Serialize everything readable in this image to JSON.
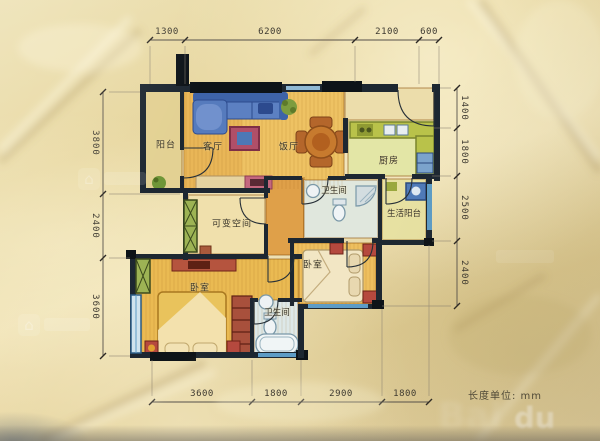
{
  "meta": {
    "unit_label": "长度单位: mm",
    "watermark": {
      "left": "Bai",
      "right": "du"
    }
  },
  "rooms": {
    "balcony": "阳台",
    "living": "客厅",
    "dining": "饭厅",
    "kitchen": "厨房",
    "bath_upper": "卫生间",
    "service_balcony": "生活阳台",
    "flex": "可变空间",
    "bedroom_right": "卧室",
    "bedroom_master": "卧室",
    "bath_lower": "卫生间"
  },
  "dimensions": {
    "unit": "mm",
    "top": [
      "1300",
      "6200",
      "2100",
      "600"
    ],
    "left": [
      "3800",
      "2400",
      "3600"
    ],
    "right": [
      "1400",
      "1800",
      "2500",
      "2400"
    ],
    "bottom": [
      "3600",
      "1800",
      "2900",
      "1800"
    ]
  }
}
